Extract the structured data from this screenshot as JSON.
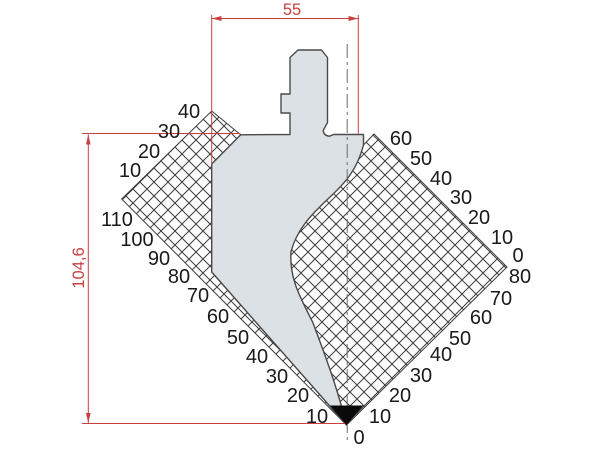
{
  "dimensions": {
    "width": {
      "value": "55"
    },
    "height": {
      "value": "104,6"
    }
  },
  "scales": {
    "groups": [
      {
        "name": "left-top-scale",
        "labels": [
          {
            "t": "40",
            "x": 189,
            "y": 111
          },
          {
            "t": "30",
            "x": 169,
            "y": 131
          },
          {
            "t": "20",
            "x": 149,
            "y": 151
          },
          {
            "t": "10",
            "x": 130,
            "y": 170
          }
        ]
      },
      {
        "name": "left-bottom-scale",
        "labels": [
          {
            "t": "110",
            "x": 117,
            "y": 219
          },
          {
            "t": "100",
            "x": 137,
            "y": 239
          },
          {
            "t": "90",
            "x": 159,
            "y": 258
          },
          {
            "t": "80",
            "x": 179,
            "y": 276
          },
          {
            "t": "70",
            "x": 198,
            "y": 295
          },
          {
            "t": "60",
            "x": 218,
            "y": 316
          },
          {
            "t": "50",
            "x": 238,
            "y": 337
          },
          {
            "t": "40",
            "x": 257,
            "y": 356
          },
          {
            "t": "30",
            "x": 277,
            "y": 376
          },
          {
            "t": "20",
            "x": 298,
            "y": 395
          },
          {
            "t": "10",
            "x": 317,
            "y": 416
          }
        ]
      },
      {
        "name": "right-top-scale",
        "labels": [
          {
            "t": "60",
            "x": 401,
            "y": 138
          },
          {
            "t": "50",
            "x": 421,
            "y": 158
          },
          {
            "t": "40",
            "x": 441,
            "y": 178
          },
          {
            "t": "30",
            "x": 461,
            "y": 197
          },
          {
            "t": "20",
            "x": 479,
            "y": 217
          },
          {
            "t": "10",
            "x": 502,
            "y": 237
          },
          {
            "t": "0",
            "x": 518,
            "y": 255
          }
        ]
      },
      {
        "name": "right-bottom-scale",
        "labels": [
          {
            "t": "80",
            "x": 520,
            "y": 276
          },
          {
            "t": "70",
            "x": 501,
            "y": 298
          },
          {
            "t": "60",
            "x": 481,
            "y": 317
          },
          {
            "t": "50",
            "x": 460,
            "y": 338
          },
          {
            "t": "40",
            "x": 441,
            "y": 354
          },
          {
            "t": "30",
            "x": 421,
            "y": 375
          },
          {
            "t": "20",
            "x": 400,
            "y": 395
          },
          {
            "t": "10",
            "x": 380,
            "y": 416
          }
        ]
      },
      {
        "name": "tip-scale",
        "labels": [
          {
            "t": "0",
            "x": 359,
            "y": 437
          }
        ]
      }
    ]
  },
  "colors": {
    "accent_red": "#c8403f",
    "punch_fill": "#dce1e6",
    "outline": "#4a4a4a",
    "hatch_line": "#3c3c3c",
    "label_text": "#1a1a1a",
    "tip_black": "#0a0a0a",
    "centerline": "#6a6a6a",
    "background": "#ffffff"
  }
}
